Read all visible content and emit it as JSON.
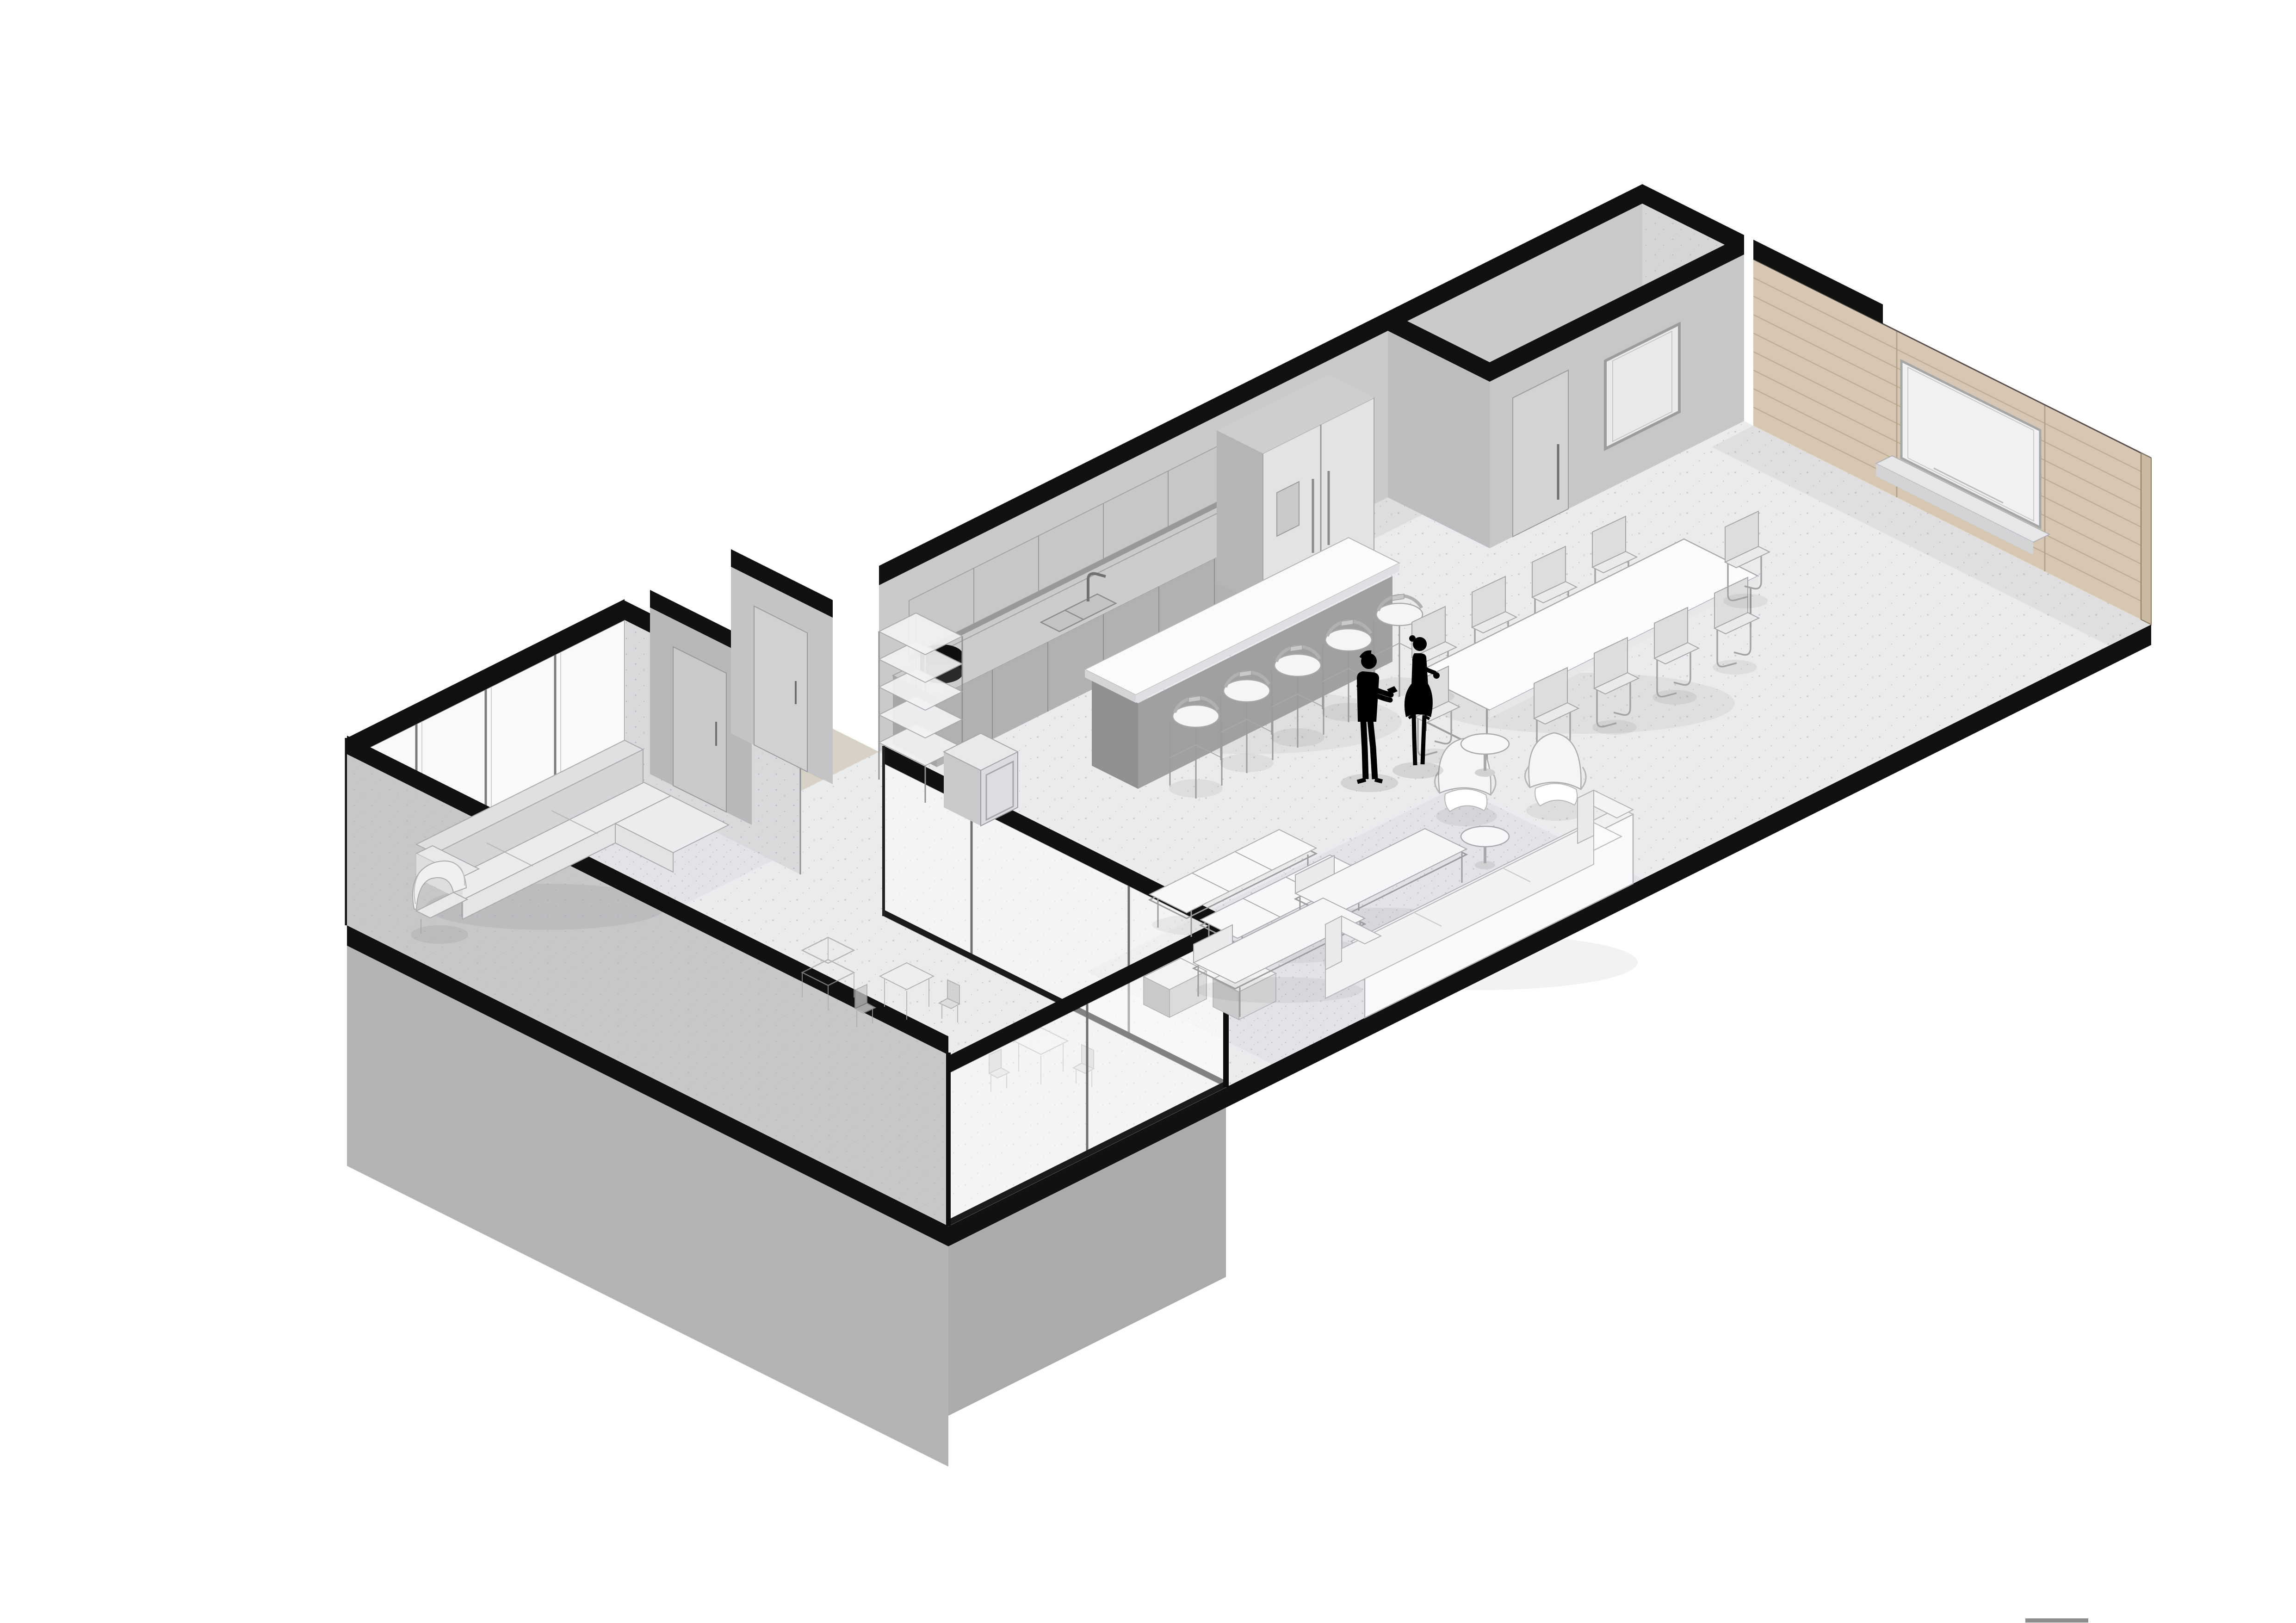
{
  "scene": {
    "type": "axonometric-cutaway-floor-plan",
    "style": "monochrome architectural render (Revit-like), white background",
    "people_count": 2,
    "people": [
      {
        "id": "man",
        "pose": "standing, offering object",
        "color": "#000000"
      },
      {
        "id": "woman",
        "pose": "standing in dress, holding bag",
        "color": "#000000"
      }
    ],
    "rooms": [
      {
        "name": "kitchen",
        "furniture": [
          "counter-run with double sink and faucet",
          "upper cabinets",
          "black countertop appliance",
          "tall cabinet with double-door fridge and water dispenser",
          "island with white top",
          "5 bar stools"
        ]
      },
      {
        "name": "pantry",
        "furniture": [
          "white L-counter",
          "door with long pull handle",
          "framed pass-through panel"
        ]
      },
      {
        "name": "dining",
        "furniture": [
          "long white dining table",
          "10 cantilever chairs"
        ]
      },
      {
        "name": "lounge",
        "furniture": [
          "speckled area rug",
          "2 metal-frame daybenches",
          "2 chaise daybeds",
          "2 cube side tables",
          "long white sofa",
          "2 white wing chairs",
          "round side table",
          "round coffee table"
        ]
      },
      {
        "name": "living-wing",
        "furniture": [
          "L-sectional sofa with chaise",
          "woven armchair",
          "speckled rug"
        ]
      },
      {
        "name": "entry",
        "furniture": [
          "wood plank corridor",
          "2 doors",
          "5-shelf etagere",
          "glass-door mini fridge"
        ]
      },
      {
        "name": "terrace-room",
        "furniture": [
          "2 cafe tables with chairs",
          "serving trolley"
        ]
      }
    ],
    "walls": [
      "glazed curtain wall with black cut cap (NW)",
      "speckled concrete partition",
      "gray entry walls with doors",
      "kitchen back wall",
      "black-capped pantry box",
      "wood-slat feature wall with recessed whiteboard and ledge",
      "interior glass partition to terrace",
      "solid gray exterior wall with podium below"
    ]
  },
  "colors": {
    "background": "#ffffff",
    "floor": "#eaebed",
    "rug": "#e2e3e6",
    "wood_floor": "#d8d2c6",
    "wall_gray": "#c9cacb",
    "wall_speckled": "#d8d9db",
    "wall_exterior": "#c6c7c9",
    "podium": "#b3b4b6",
    "cut_black": "#111111",
    "wood_wall": "#d7c7b2",
    "wood_line": "#b9a98f",
    "whiteboard": "#f0f1f2",
    "cabinet": "#b0b1b3",
    "counter": "#cbccce",
    "upper_cabinet": "#c6c7c9",
    "fridge": "#e2e3e5",
    "island_top": "#fbfbfc",
    "island_base": "#9fa0a2",
    "furniture_white": "#f6f7f8",
    "glass": "#ffffff",
    "silhouette": "#000000",
    "appliance_black": "#1c1c1e",
    "bottom_bar": "#8e8e8e"
  },
  "counts": {
    "bar_stools": 5,
    "dining_chairs": 10,
    "etagere_shelves": 5,
    "glass_mullions_nw": 3,
    "cafe_sets": 2
  },
  "footer": {
    "bottom_bar_visible": true
  }
}
